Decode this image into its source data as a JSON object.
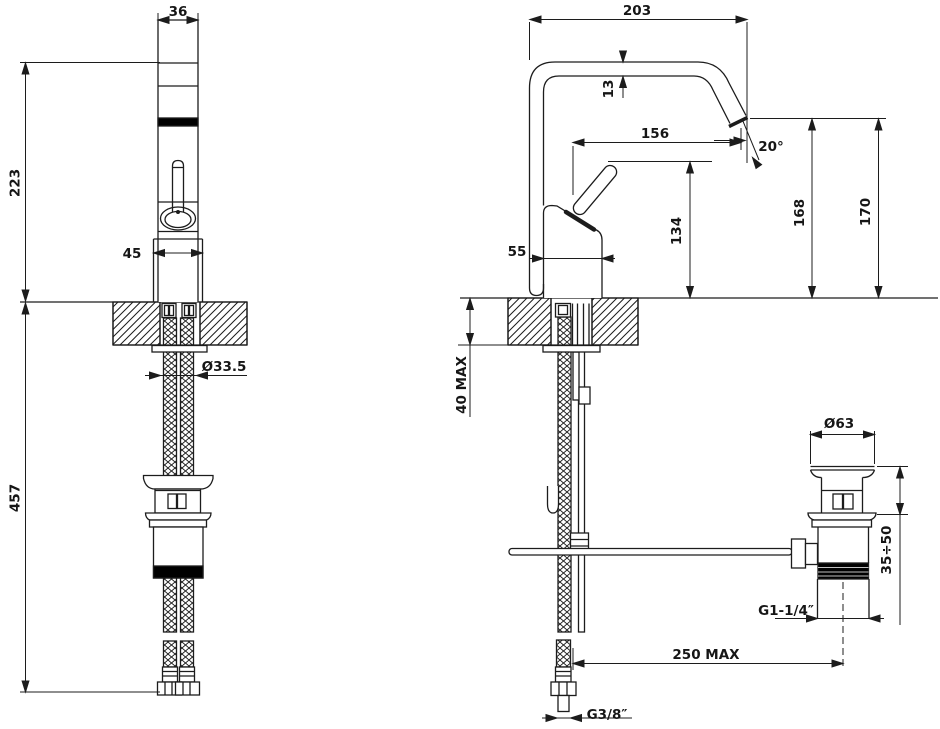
{
  "colors": {
    "background": "#ffffff",
    "line": "#1c1c1c",
    "accent_fill": "#000000"
  },
  "front": {
    "spout_width": "36",
    "body_height": "223",
    "base_width": "45",
    "hose_drop": "457",
    "shank_diameter": "Ø33.5"
  },
  "side": {
    "spout_reach": "203",
    "spout_tube": "13",
    "spout_projection": "156",
    "aerator_angle": "20°",
    "body_depth": "55",
    "handle_height": "134",
    "outlet_height": "168",
    "spout_height": "170",
    "deck_thickness": "40 MAX",
    "waste_diameter": "Ø63",
    "waste_adjustment": "35÷50",
    "waste_thread": "G1-1/4″",
    "rod_reach": "250 MAX",
    "hose_thread": "G3/8″"
  }
}
